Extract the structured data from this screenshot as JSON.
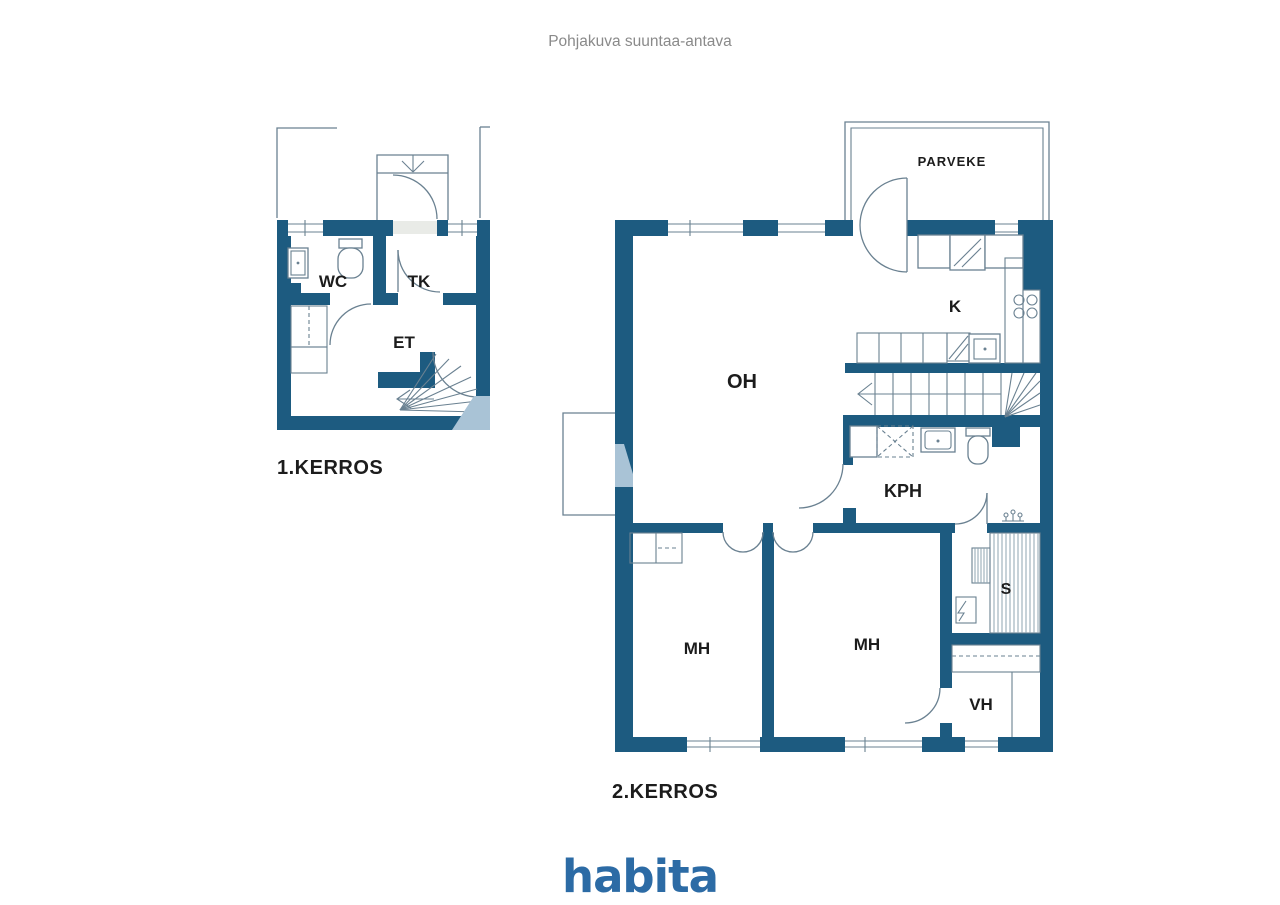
{
  "title": "Pohjakuva suuntaa-antava",
  "floor1": {
    "caption": "1.KERROS",
    "rooms": {
      "wc": "WC",
      "tk": "TK",
      "et": "ET"
    }
  },
  "floor2": {
    "caption": "2.KERROS",
    "balcony": "PARVEKE",
    "rooms": {
      "oh": "OH",
      "k": "K",
      "kph": "KPH",
      "mh1": "MH",
      "mh2": "MH",
      "s": "S",
      "vh": "VH"
    }
  },
  "logo": "habita",
  "colors": {
    "wall": "#1d5b80",
    "wall-light": "#a9c3d6",
    "line": "#6a8191",
    "hatch": "#8fa4b1",
    "threshold": "#e9ebe7",
    "label": "#1c1c1c",
    "title": "#8a8a8a",
    "logo": "#2c6ba5",
    "bg": "#ffffff"
  }
}
